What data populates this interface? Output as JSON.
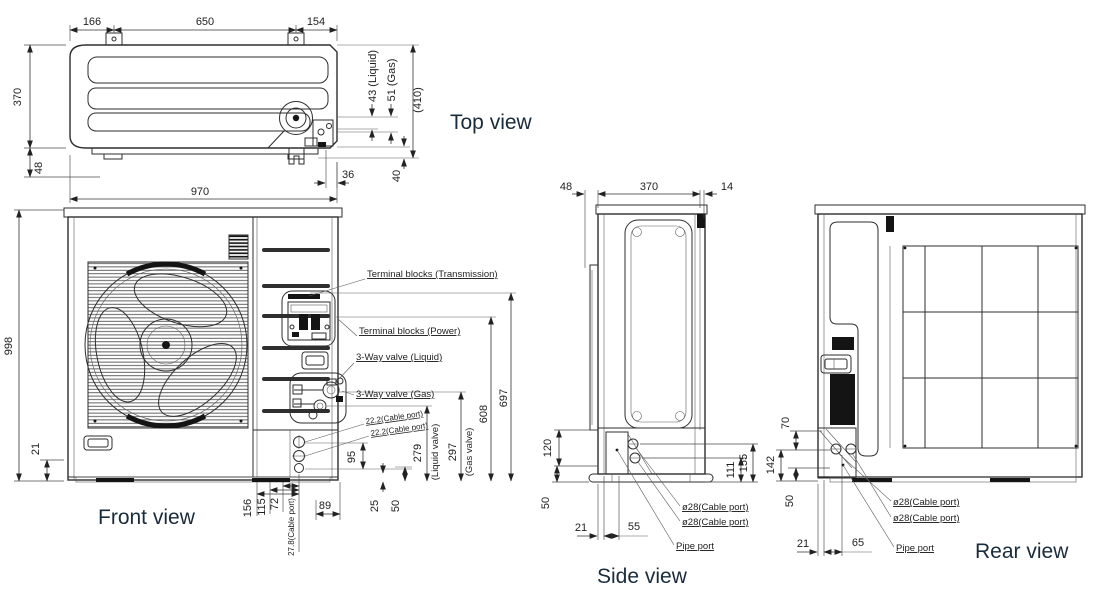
{
  "drawing_title": "Outdoor unit dimensional drawing",
  "top_view": {
    "label": "Top view",
    "dims": {
      "d166": "166",
      "d650": "650",
      "d154": "154",
      "d370": "370",
      "d48": "48",
      "d970": "970",
      "d43": "43 (Liquid)",
      "d51": "51 (Gas)",
      "d410": "(410)",
      "d36": "36",
      "d40": "40"
    }
  },
  "front_view": {
    "label": "Front view",
    "dims": {
      "d998": "998",
      "d21": "21",
      "d156": "156",
      "d115": "115",
      "d72": "72",
      "d89": "89",
      "d25": "25",
      "d50": "50",
      "d95": "95",
      "d279": "279",
      "d279n": "(Liquid valve)",
      "d297": "297",
      "d297n": "(Gas valve)",
      "d608": "608",
      "d697": "697",
      "c222": "22.2(Cable port)",
      "c278": "27.8(Cable port)"
    },
    "callouts": {
      "tb_trans": "Terminal blocks (Transmission)",
      "tb_power": "Terminal blocks (Power)",
      "v_liquid": "3-Way valve (Liquid)",
      "v_gas": "3-Way valve (Gas)"
    }
  },
  "side_view": {
    "label": "Side view",
    "dims": {
      "d48": "48",
      "d370": "370",
      "d14": "14",
      "d120": "120",
      "d50": "50",
      "d21": "21",
      "d55": "55",
      "d111": "111",
      "d155": "155"
    },
    "callouts": {
      "cable": "ø28(Cable port)",
      "pipe": "Pipe port"
    }
  },
  "rear_view": {
    "label": "Rear view",
    "dims": {
      "d70": "70",
      "d142": "142",
      "d50": "50",
      "d21": "21",
      "d65": "65"
    },
    "callouts": {
      "cable": "ø28(Cable port)",
      "pipe": "Pipe port"
    }
  }
}
